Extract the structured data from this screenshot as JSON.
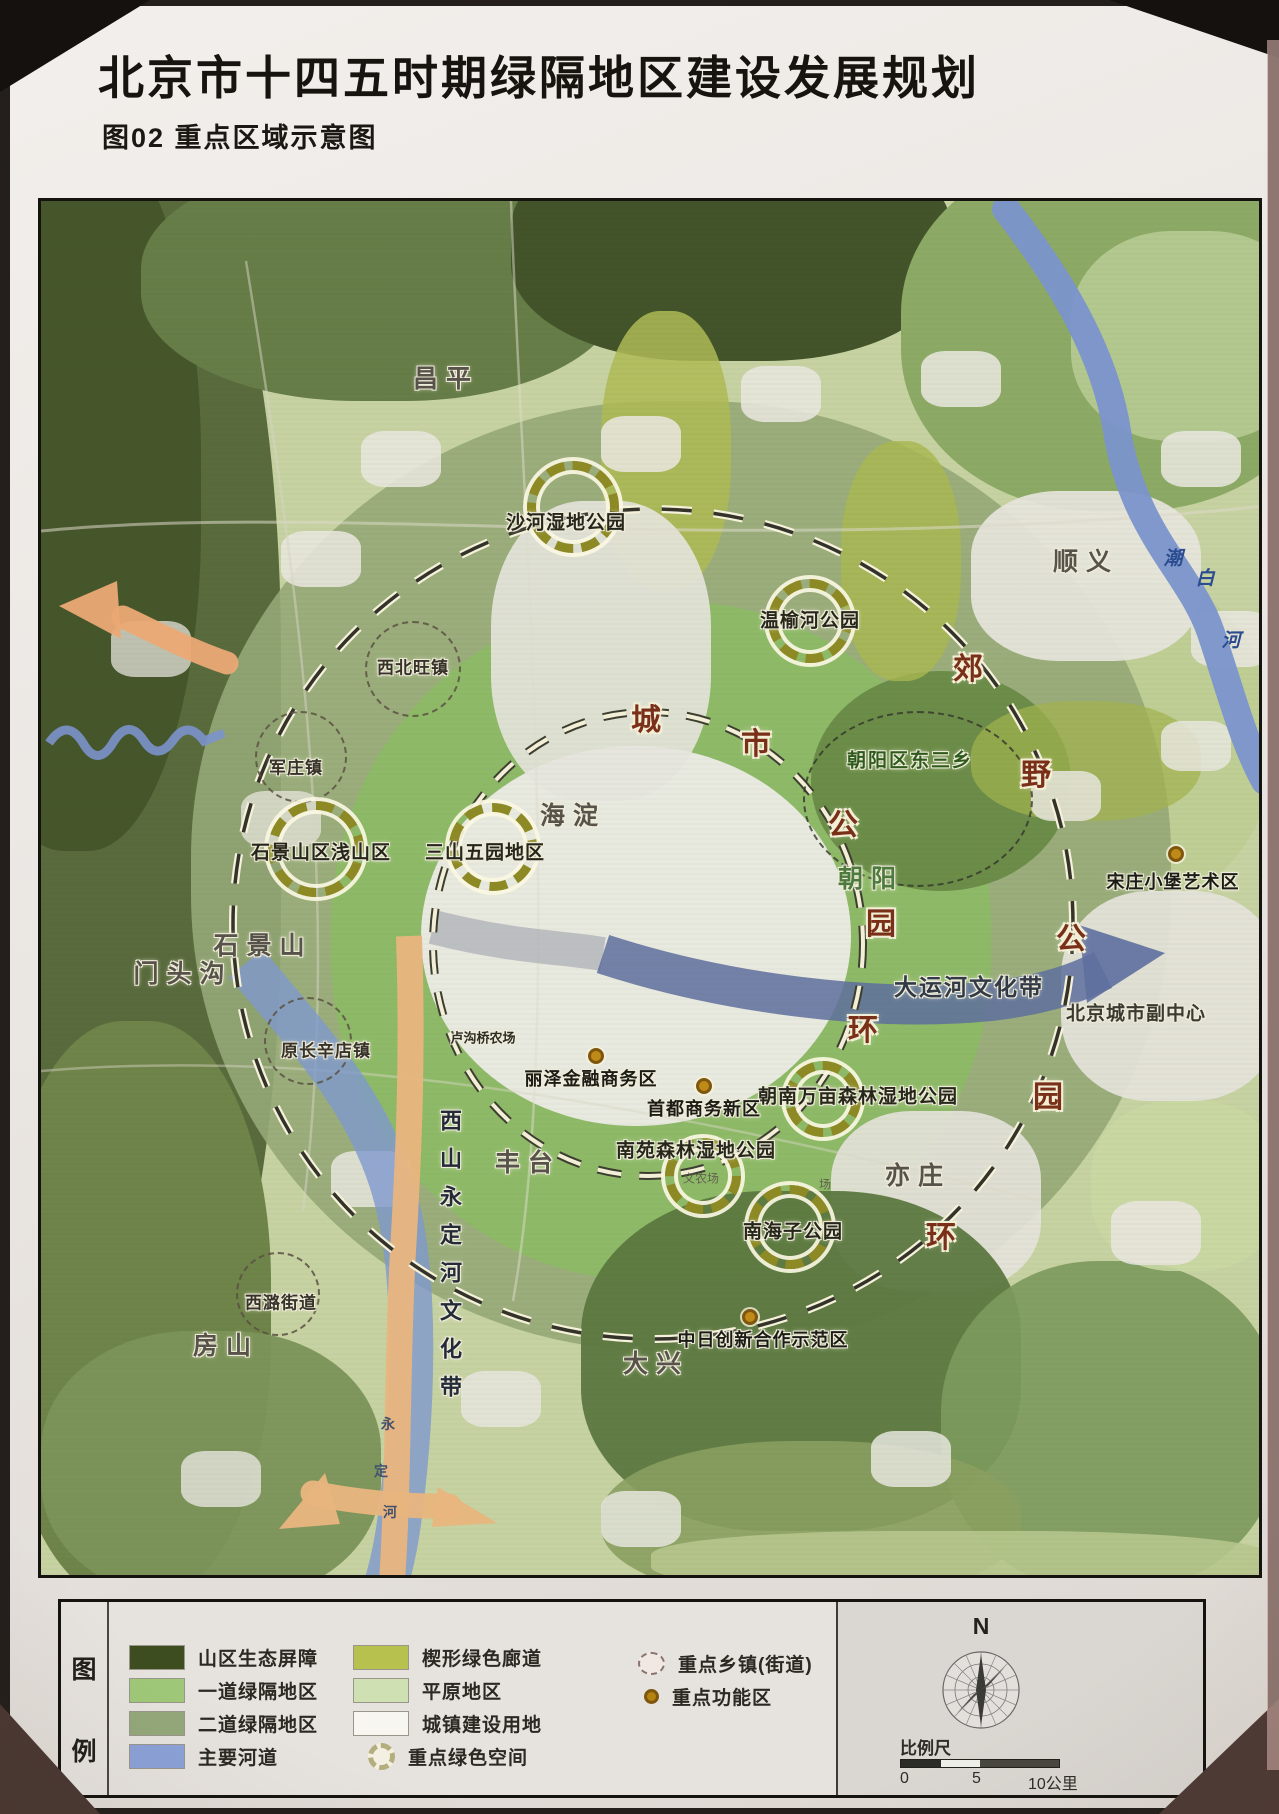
{
  "title": "北京市十四五时期绿隔地区建设发展规划",
  "subtitle": "图02 重点区域示意图",
  "legend": {
    "key_top": "图",
    "key_bottom": "例",
    "columns": [
      {
        "items": [
          {
            "type": "fill",
            "swatch": "#3d4d1f",
            "label": "山区生态屏障"
          },
          {
            "type": "fill",
            "swatch": "#9fc878",
            "label": "一道绿隔地区"
          },
          {
            "type": "fill",
            "swatch": "#94a87a",
            "label": "二道绿隔地区"
          },
          {
            "type": "fill",
            "swatch": "#8ba2d8",
            "label": "主要河道"
          }
        ]
      },
      {
        "items": [
          {
            "type": "fill",
            "swatch": "#b7c24e",
            "label": "楔形绿色廊道"
          },
          {
            "type": "fill",
            "swatch": "#cfe0b2",
            "label": "平原地区"
          },
          {
            "type": "fill",
            "swatch": "#f7f6f1",
            "label": "城镇建设用地"
          },
          {
            "type": "rosette",
            "label": "重点绿色空间"
          }
        ]
      },
      {
        "items": [
          {
            "type": "dashed-circle",
            "label": "重点乡镇(街道)"
          },
          {
            "type": "dot",
            "label": "重点功能区"
          }
        ]
      }
    ],
    "compass_label": "N",
    "scale_label": "比例尺",
    "scale_ticks": [
      "0",
      "5",
      "10公里"
    ]
  },
  "map": {
    "labels": [
      {
        "text": "昌平",
        "x": 405,
        "y": 176,
        "cls": "district"
      },
      {
        "text": "顺义",
        "x": 1045,
        "y": 359,
        "cls": "district"
      },
      {
        "text": "海淀",
        "x": 532,
        "y": 613,
        "cls": "district"
      },
      {
        "text": "石景山",
        "x": 222,
        "y": 743,
        "cls": "district"
      },
      {
        "text": "门头沟",
        "x": 142,
        "y": 771,
        "cls": "district"
      },
      {
        "text": "丰台",
        "x": 487,
        "y": 960,
        "cls": "district"
      },
      {
        "text": "房山",
        "x": 185,
        "y": 1143,
        "cls": "district"
      },
      {
        "text": "大兴",
        "x": 615,
        "y": 1161,
        "cls": "district"
      },
      {
        "text": "亦庄",
        "x": 877,
        "y": 973,
        "cls": "district"
      },
      {
        "text": "朝阳",
        "x": 830,
        "y": 676,
        "cls": "district-green"
      },
      {
        "text": "北京城市副中心",
        "x": 1095,
        "y": 811,
        "cls": "subcenter"
      },
      {
        "text": "大运河文化带",
        "x": 928,
        "y": 784,
        "cls": "canal"
      },
      {
        "text": "朝阳区东三乡",
        "x": 869,
        "y": 558,
        "cls": "area"
      },
      {
        "text": "沙河湿地公园",
        "x": 525,
        "y": 320,
        "cls": "park"
      },
      {
        "text": "温榆河公园",
        "x": 769,
        "y": 418,
        "cls": "park"
      },
      {
        "text": "石景山区浅山区",
        "x": 280,
        "y": 650,
        "cls": "park"
      },
      {
        "text": "三山五园地区",
        "x": 444,
        "y": 650,
        "cls": "park"
      },
      {
        "text": "朝南万亩森林湿地公园",
        "x": 817,
        "y": 894,
        "cls": "park"
      },
      {
        "text": "南苑森林湿地公园",
        "x": 655,
        "y": 948,
        "cls": "park"
      },
      {
        "text": "南海子公园",
        "x": 752,
        "y": 1029,
        "cls": "park"
      },
      {
        "text": "西北旺镇",
        "x": 372,
        "y": 465,
        "cls": "town"
      },
      {
        "text": "军庄镇",
        "x": 255,
        "y": 565,
        "cls": "town"
      },
      {
        "text": "原长辛店镇",
        "x": 285,
        "y": 848,
        "cls": "town"
      },
      {
        "text": "西潞街道",
        "x": 240,
        "y": 1100,
        "cls": "town"
      },
      {
        "text": "宋庄小堡艺术区",
        "x": 1132,
        "y": 680,
        "cls": "poi"
      },
      {
        "text": "丽泽金融商务区",
        "x": 550,
        "y": 877,
        "cls": "poi"
      },
      {
        "text": "首都商务新区",
        "x": 663,
        "y": 907,
        "cls": "poi"
      },
      {
        "text": "中日创新合作示范区",
        "x": 722,
        "y": 1138,
        "cls": "poi"
      },
      {
        "text": "城",
        "x": 605,
        "y": 516,
        "cls": "ring-i"
      },
      {
        "text": "市",
        "x": 715,
        "y": 540,
        "cls": "ring-i"
      },
      {
        "text": "公",
        "x": 802,
        "y": 621,
        "cls": "ring-i"
      },
      {
        "text": "园",
        "x": 840,
        "y": 720,
        "cls": "ring-i"
      },
      {
        "text": "环",
        "x": 822,
        "y": 826,
        "cls": "ring-i"
      },
      {
        "text": "郊",
        "x": 927,
        "y": 465,
        "cls": "ring-o"
      },
      {
        "text": "野",
        "x": 995,
        "y": 571,
        "cls": "ring-o"
      },
      {
        "text": "公",
        "x": 1030,
        "y": 735,
        "cls": "ring-o"
      },
      {
        "text": "园",
        "x": 1007,
        "y": 893,
        "cls": "ring-o"
      },
      {
        "text": "环",
        "x": 900,
        "y": 1033,
        "cls": "ring-o"
      },
      {
        "text": "潮",
        "x": 1132,
        "y": 356,
        "cls": "river-cb"
      },
      {
        "text": "白",
        "x": 1164,
        "y": 376,
        "cls": "river-cb"
      },
      {
        "text": "河",
        "x": 1190,
        "y": 438,
        "cls": "river-cb"
      },
      {
        "text": "永",
        "x": 347,
        "y": 1223,
        "cls": "river-yd"
      },
      {
        "text": "定",
        "x": 340,
        "y": 1270,
        "cls": "river-yd"
      },
      {
        "text": "河",
        "x": 349,
        "y": 1311,
        "cls": "river-yd"
      },
      {
        "text": "西山永定河文化带",
        "x": 408,
        "y": 1060,
        "cls": "corridor-v"
      },
      {
        "text": "卢沟桥农场",
        "x": 442,
        "y": 836,
        "cls": "small"
      },
      {
        "text": "义农场",
        "x": 660,
        "y": 977,
        "cls": "tiny"
      },
      {
        "text": "场",
        "x": 784,
        "y": 983,
        "cls": "tiny"
      }
    ],
    "green_space_rings": [
      {
        "x": 532,
        "y": 306,
        "r": 46
      },
      {
        "x": 769,
        "y": 420,
        "r": 42
      },
      {
        "x": 275,
        "y": 648,
        "r": 48
      },
      {
        "x": 452,
        "y": 646,
        "r": 44
      },
      {
        "x": 782,
        "y": 898,
        "r": 38
      },
      {
        "x": 662,
        "y": 975,
        "r": 38
      },
      {
        "x": 749,
        "y": 1026,
        "r": 42
      }
    ],
    "town_circles": [
      {
        "x": 372,
        "y": 468,
        "r": 48
      },
      {
        "x": 260,
        "y": 556,
        "r": 46
      },
      {
        "x": 267,
        "y": 840,
        "r": 44
      },
      {
        "x": 237,
        "y": 1093,
        "r": 42
      }
    ],
    "poi_dots": [
      {
        "x": 1135,
        "y": 653
      },
      {
        "x": 555,
        "y": 855
      },
      {
        "x": 663,
        "y": 885
      },
      {
        "x": 709,
        "y": 1116
      }
    ],
    "area_ellipses": [
      {
        "x": 877,
        "y": 598,
        "rx": 115,
        "ry": 88
      }
    ]
  }
}
